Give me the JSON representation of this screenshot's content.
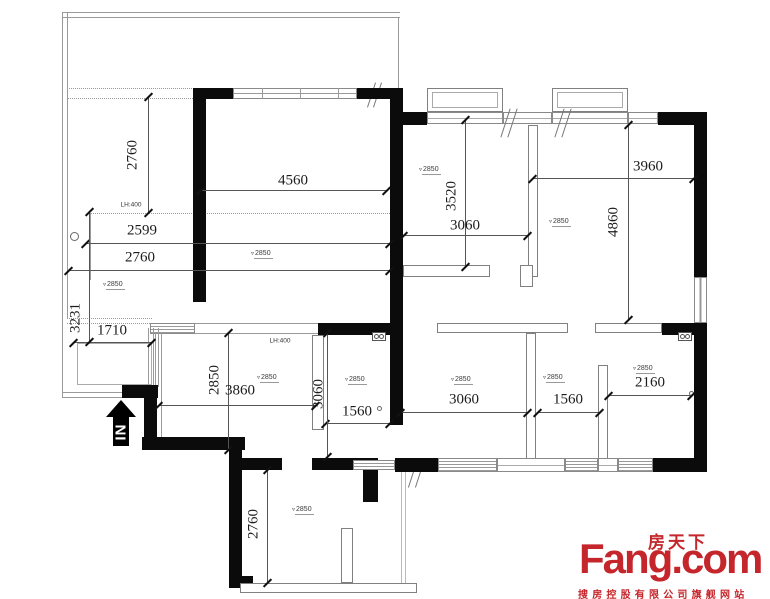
{
  "plan": {
    "dims": {
      "terrace_height": "2760",
      "left_row_1": "2599",
      "left_row_2": "2760",
      "left_column": "3231",
      "entry_width": "1710",
      "living_width": "4560",
      "room_top_mid_height": "3520",
      "room_top_mid_width": "3060",
      "room_top_right_width": "3960",
      "room_top_right_height": "4860",
      "kitchen_height": "2850",
      "kitchen_width": "3860",
      "bath1_height": "3060",
      "bath1_width": "1560",
      "hall_width": "3060",
      "bath2_width": "1560",
      "room_bottom_right_width": "2160",
      "bottom_room_height": "2760"
    },
    "ceiling_height_mark": "2850",
    "level_triangle_glyph": "▿",
    "notes": {
      "lh_left": "LH:400",
      "lh_kitchen": "LH:400"
    },
    "entry_arrow_label": "IN"
  },
  "logo": {
    "chinese": "房天下",
    "name": "Fang.com",
    "tagline": "搜房控股有限公司旗舰网站",
    "brand_color": "#c5262b"
  },
  "colors": {
    "wall": "#0b0b0b",
    "dim_line": "#555555",
    "thin_line": "#9a9a9a"
  }
}
